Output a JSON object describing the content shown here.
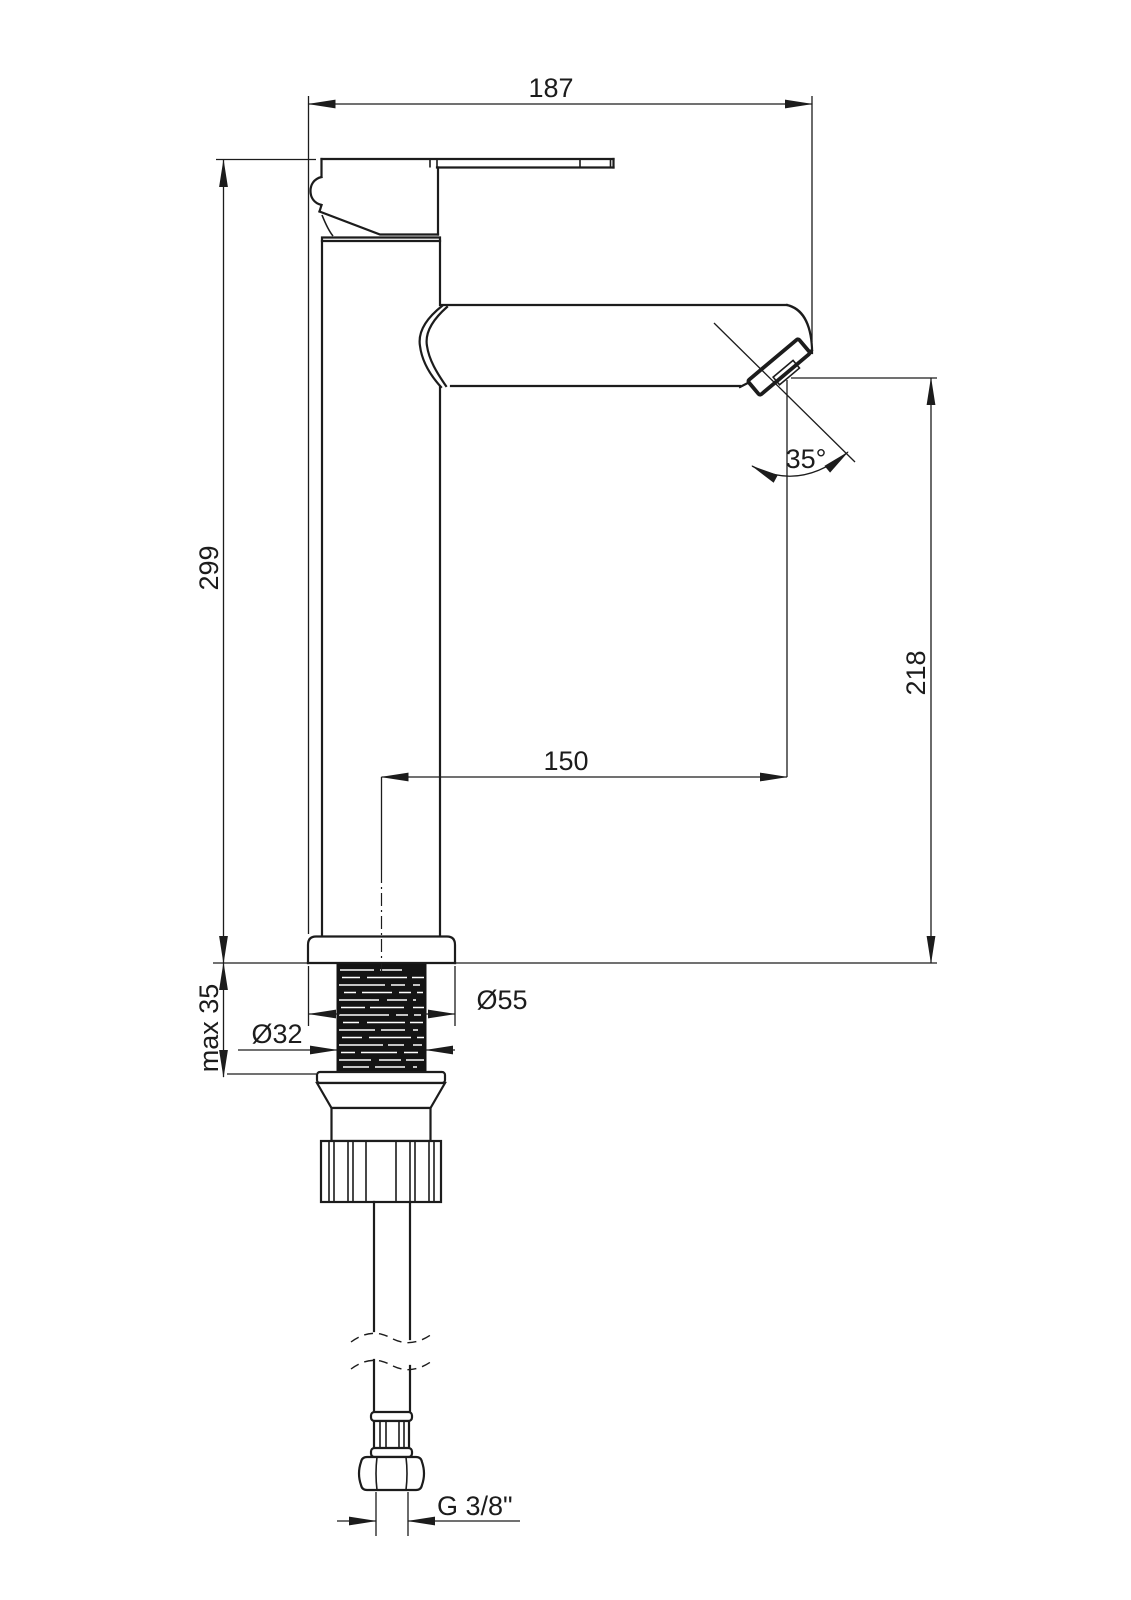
{
  "drawing": {
    "type": "technical-drawing",
    "subject": "single-lever tall washbasin mixer tap, side view with mounting hardware",
    "background_color": "#ffffff",
    "line_color": "#1c1c1c",
    "labels": {
      "total_width": "187",
      "total_height": "299",
      "spout_outlet_height": "218",
      "spout_reach": "150",
      "spray_angle": "35°",
      "max_deck_thickness": "max 35",
      "base_diameter": "Ø55",
      "shank_diameter": "Ø32",
      "hose_connection": "G 3/8\""
    }
  }
}
